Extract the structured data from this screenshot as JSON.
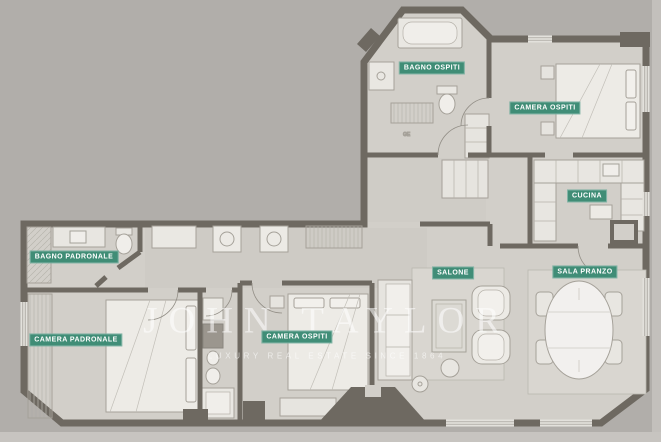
{
  "document": {
    "type": "apartment-floor-plan"
  },
  "rooms": [
    {
      "id": "bagno-ospiti",
      "label": "BAGNO OSPITI"
    },
    {
      "id": "camera-ospiti-nord",
      "label": "CAMERA OSPITI"
    },
    {
      "id": "cucina",
      "label": "CUCINA"
    },
    {
      "id": "bagno-padronale",
      "label": "BAGNO PADRONALE"
    },
    {
      "id": "camera-padronale",
      "label": "CAMERA PADRONALE"
    },
    {
      "id": "camera-ospiti-sud",
      "label": "CAMERA OSPITI"
    },
    {
      "id": "salone",
      "label": "SALONE"
    },
    {
      "id": "sala-pranzo",
      "label": "SALA PRANZO"
    }
  ],
  "annotations": {
    "closet_unit": "GE"
  },
  "watermark": {
    "brand": "JOHN TAYLOR",
    "tagline": "LUXURY REAL ESTATE SINCE 1864"
  },
  "colors": {
    "background": "#b1aeaa",
    "floor": "#d2cfc9",
    "wall": "#6e6961",
    "label_bg": "#38896f",
    "label_text": "#ffffff",
    "watermark": "rgba(255,255,255,0.55)"
  }
}
